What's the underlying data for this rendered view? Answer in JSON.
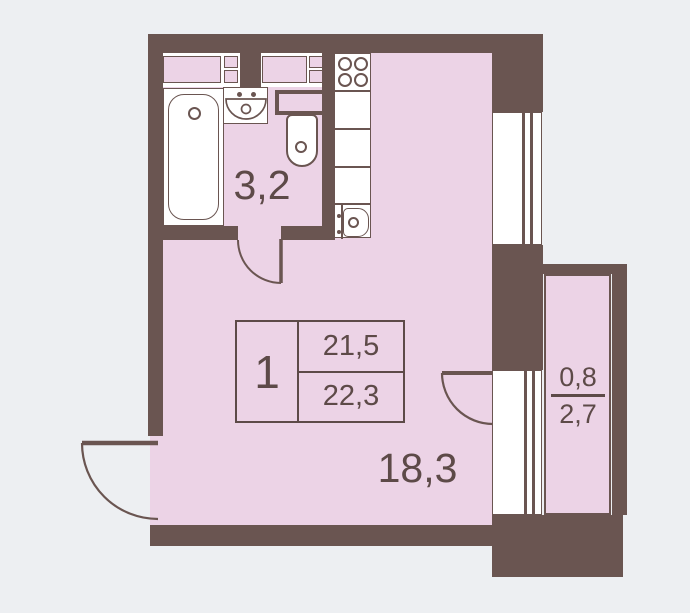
{
  "plan": {
    "type": "floor-plan",
    "areas": {
      "bathroom": "3,2",
      "living_room": "18,3",
      "balcony_reduced": "0,8",
      "balcony_full": "2,7"
    },
    "info_table": {
      "unit_number": "1",
      "living_area": "21,5",
      "total_area": "22,3"
    },
    "fixtures": [
      "bathtub-icon",
      "washbasin-icon",
      "toilet-icon",
      "stove-icon",
      "kitchen-sink-icon",
      "window-icon",
      "door-swing-icon",
      "cabinet-icon"
    ],
    "colors": {
      "wall": "#6a5551",
      "floor_fill": "#ecd3e6",
      "background": "#edeff2",
      "fixture_fill": "#ffffff",
      "text": "#5d4a48"
    }
  }
}
